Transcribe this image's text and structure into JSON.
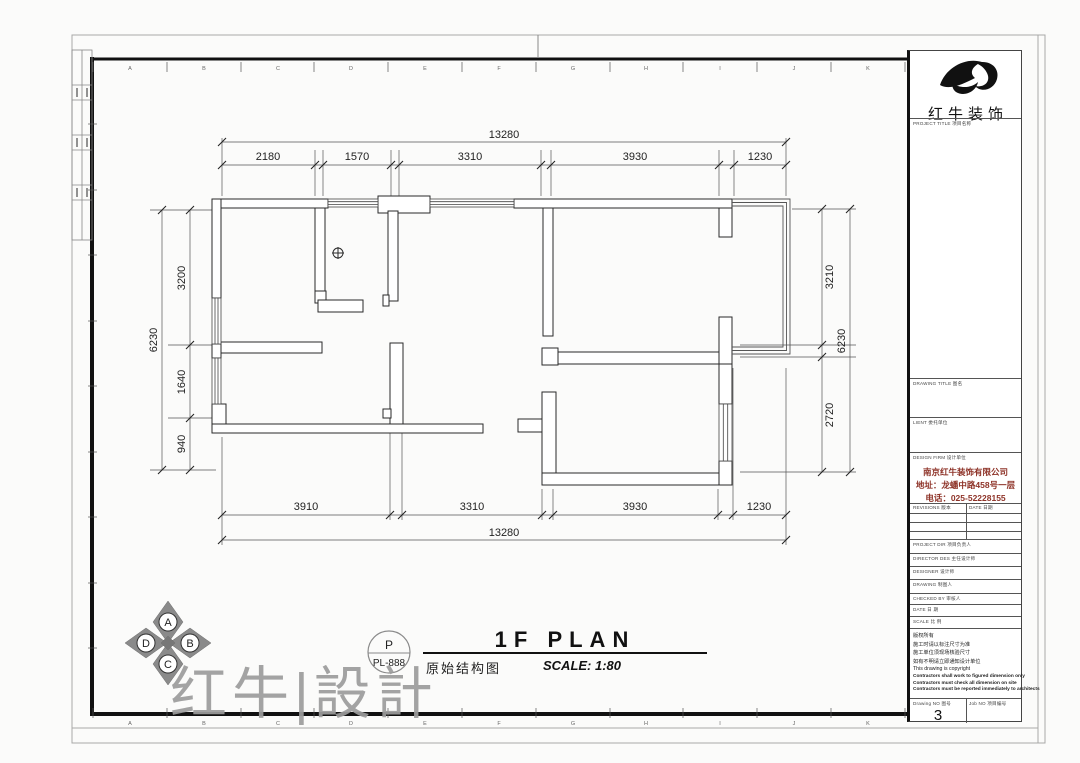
{
  "logo": {
    "name": "红牛装饰"
  },
  "border": {
    "letters": [
      "A",
      "B",
      "C",
      "D",
      "E",
      "F",
      "G",
      "H",
      "I",
      "J",
      "K"
    ]
  },
  "dimensions": {
    "top": {
      "total": "13280",
      "segments": [
        "2180",
        "1570",
        "3310",
        "3930",
        "1230"
      ]
    },
    "bottom": {
      "total": "13280",
      "segments": [
        "3910",
        "3310",
        "3930",
        "1230"
      ]
    },
    "left": {
      "total": "6230",
      "segments": [
        "3200",
        "1640",
        "940"
      ]
    },
    "right": {
      "total": "6230",
      "segments": [
        "3210",
        "2720"
      ]
    }
  },
  "compass": {
    "n": "A",
    "e": "B",
    "s": "C",
    "w": "D"
  },
  "footer": {
    "title": "1F PLAN",
    "scale": "SCALE: 1:80",
    "drawing_name": "原始结构图",
    "stamp_letter": "P",
    "stamp_code": "PL-888"
  },
  "watermark": {
    "text": "红牛|設計"
  },
  "title_block": {
    "project_title_label": "PROJECT TITLE  项目名称",
    "drawing_title_label": "DRAWING TITLE  图名",
    "client_label": "LIENT  委托单位",
    "design_firm_label": "DESIGN FIRM  设计单位",
    "company_name": "南京红牛装饰有限公司",
    "company_address": "地址：龙蟠中路458号一层",
    "company_phone": "电话：025-52228155",
    "revisions_label": "REVISIONS  版本",
    "date_col_label": "DATE  日期",
    "project_dir_label": "PROJECT DIR  项目负责人",
    "director_label": "DIRECTOR DES  主任设计师",
    "designer_label": "DESIGNER  设计师",
    "drawing_label": "DRAWING  制图人",
    "checked_label": "CHECKED BY  审核人",
    "date_label": "DATE  日 期",
    "scale_label": "SCALE  比 例",
    "notes": [
      "版权所有",
      "施工时请以标注尺寸为准",
      "施工单位须现场核验尺寸",
      "如有不明请立即通知设计单位",
      "This drawing is copyright",
      "Contractors shall work to figured dimension only",
      "Contractors must check all dimension on site",
      "Contractors must be reported immediately to architects"
    ],
    "drawing_no_label": "Drawing NO 图号",
    "drawing_no_value": "3",
    "job_no_label": "Job NO 项目编号"
  },
  "colors": {
    "wall_line": "#2a2a2a",
    "accent_red": "#8e3328",
    "watermark_gray": "#9c9c9c",
    "compass_gray": "#8a8a8a"
  }
}
